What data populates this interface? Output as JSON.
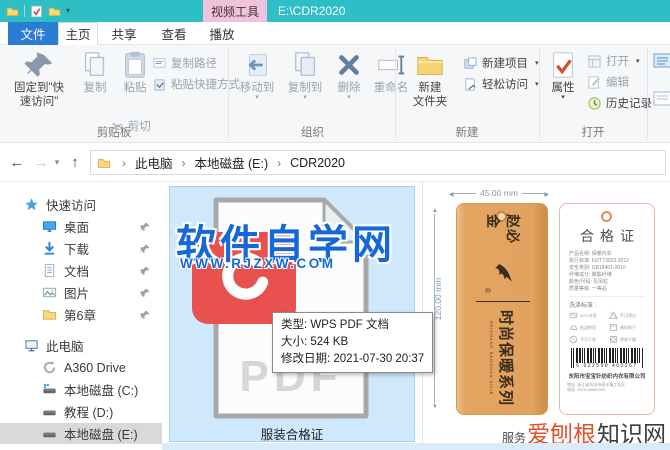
{
  "titlebar": {
    "context_tab": "视频工具",
    "title": "E:\\CDR2020"
  },
  "tabs": {
    "file": "文件",
    "home": "主页",
    "share": "共享",
    "view": "查看",
    "play": "播放"
  },
  "ribbon": {
    "clipboard": {
      "label": "剪贴板",
      "pin1": "固定到\"快",
      "pin2": "速访问\"",
      "copy": "复制",
      "paste": "粘贴",
      "cut": "剪切",
      "copy_path": "复制路径",
      "paste_shortcut": "粘贴快捷方式"
    },
    "organize": {
      "label": "组织",
      "move_to": "移动到",
      "copy_to": "复制到",
      "del": "删除",
      "rename": "重命名"
    },
    "new": {
      "label": "新建",
      "folder1": "新建",
      "folder2": "文件夹",
      "new_item": "新建项目",
      "easy_access": "轻松访问"
    },
    "open": {
      "label": "打开",
      "properties": "属性",
      "open": "打开",
      "edit": "编辑",
      "history": "历史记录"
    }
  },
  "addressbar": {
    "crumbs": [
      "此电脑",
      "本地磁盘 (E:)",
      "CDR2020"
    ]
  },
  "sidebar": {
    "items": [
      {
        "label": "快速访问"
      },
      {
        "label": "桌面"
      },
      {
        "label": "下载"
      },
      {
        "label": "文档"
      },
      {
        "label": "图片"
      },
      {
        "label": "第6章"
      },
      {
        "label": "此电脑"
      },
      {
        "label": "A360 Drive"
      },
      {
        "label": "本地磁盘 (C:)"
      },
      {
        "label": "教程 (D:)"
      },
      {
        "label": "本地磁盘 (E:)"
      }
    ]
  },
  "file": {
    "name": "服装合格证",
    "pdf_text": "PDF"
  },
  "watermark": {
    "title": "软件自学网",
    "url": "WWW.RJZXW.COM"
  },
  "tooltip": {
    "type": "类型: WPS PDF 文档",
    "size": "大小: 524 KB",
    "modified": "修改日期: 2021-07-30 20:37"
  },
  "preview": {
    "dim_width": "45.00 mm",
    "dim_height": "120.00 mm",
    "front": {
      "brand": "赵必金",
      "reg": "®",
      "series": "时尚保暖系列",
      "series_sub": "SHISHANG BAONUAN XILIE"
    },
    "back": {
      "title": "合格证",
      "info_lines": [
        "产品名称: 保暖内衣",
        "执行标准: FZ/T73022-2012",
        "安全类别: GB18401-2010",
        "纤维成分: 聚酯纤维",
        "颜色/尺码: 见吊粒",
        "质量等级: 一等品"
      ],
      "wash_title": "洗涤标准 :",
      "wash_items": [
        "40°C水洗",
        "不可漂白",
        "低温熨烫",
        "悬挂晾干",
        "不可干洗",
        "常规干燥"
      ],
      "barcode_digits": "6 922598 400267",
      "company": "东阳市宝宝针纺织内衣有限公司",
      "address1": "地址: 浙江省东阳市画水镇工业区",
      "address2": "电话: 0579-86560000"
    },
    "footer": {
      "prefix": "服务",
      "highlight": "爱刨根",
      "suffix": "知识网"
    }
  }
}
